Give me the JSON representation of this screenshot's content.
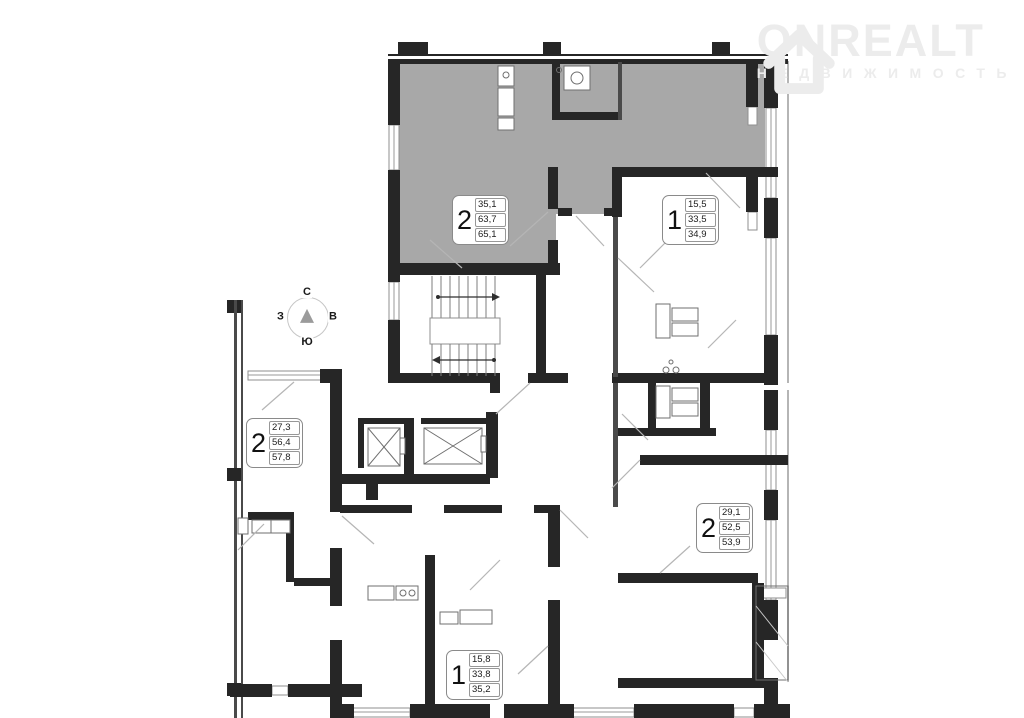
{
  "watermark": {
    "brand": "ONREALT",
    "subtitle": "НЕДВИЖИМОСТЬ"
  },
  "compass": {
    "north": "С",
    "south": "Ю",
    "west": "З",
    "east": "В"
  },
  "apartments": [
    {
      "rooms": "2",
      "areas": [
        "35,1",
        "63,7",
        "65,1"
      ],
      "highlighted": true,
      "position": "top-left"
    },
    {
      "rooms": "1",
      "areas": [
        "15,5",
        "33,5",
        "34,9"
      ],
      "highlighted": false,
      "position": "top-right"
    },
    {
      "rooms": "2",
      "areas": [
        "27,3",
        "56,4",
        "57,8"
      ],
      "highlighted": false,
      "position": "left"
    },
    {
      "rooms": "2",
      "areas": [
        "29,1",
        "52,5",
        "53,9"
      ],
      "highlighted": false,
      "position": "bottom-right"
    },
    {
      "rooms": "1",
      "areas": [
        "15,8",
        "33,8",
        "35,2"
      ],
      "highlighted": false,
      "position": "bottom-middle"
    }
  ],
  "colors": {
    "wall": "#262626",
    "highlight_fill": "#a8a8a8",
    "door_line": "#b5b5b5",
    "watermark": "#ececec"
  }
}
